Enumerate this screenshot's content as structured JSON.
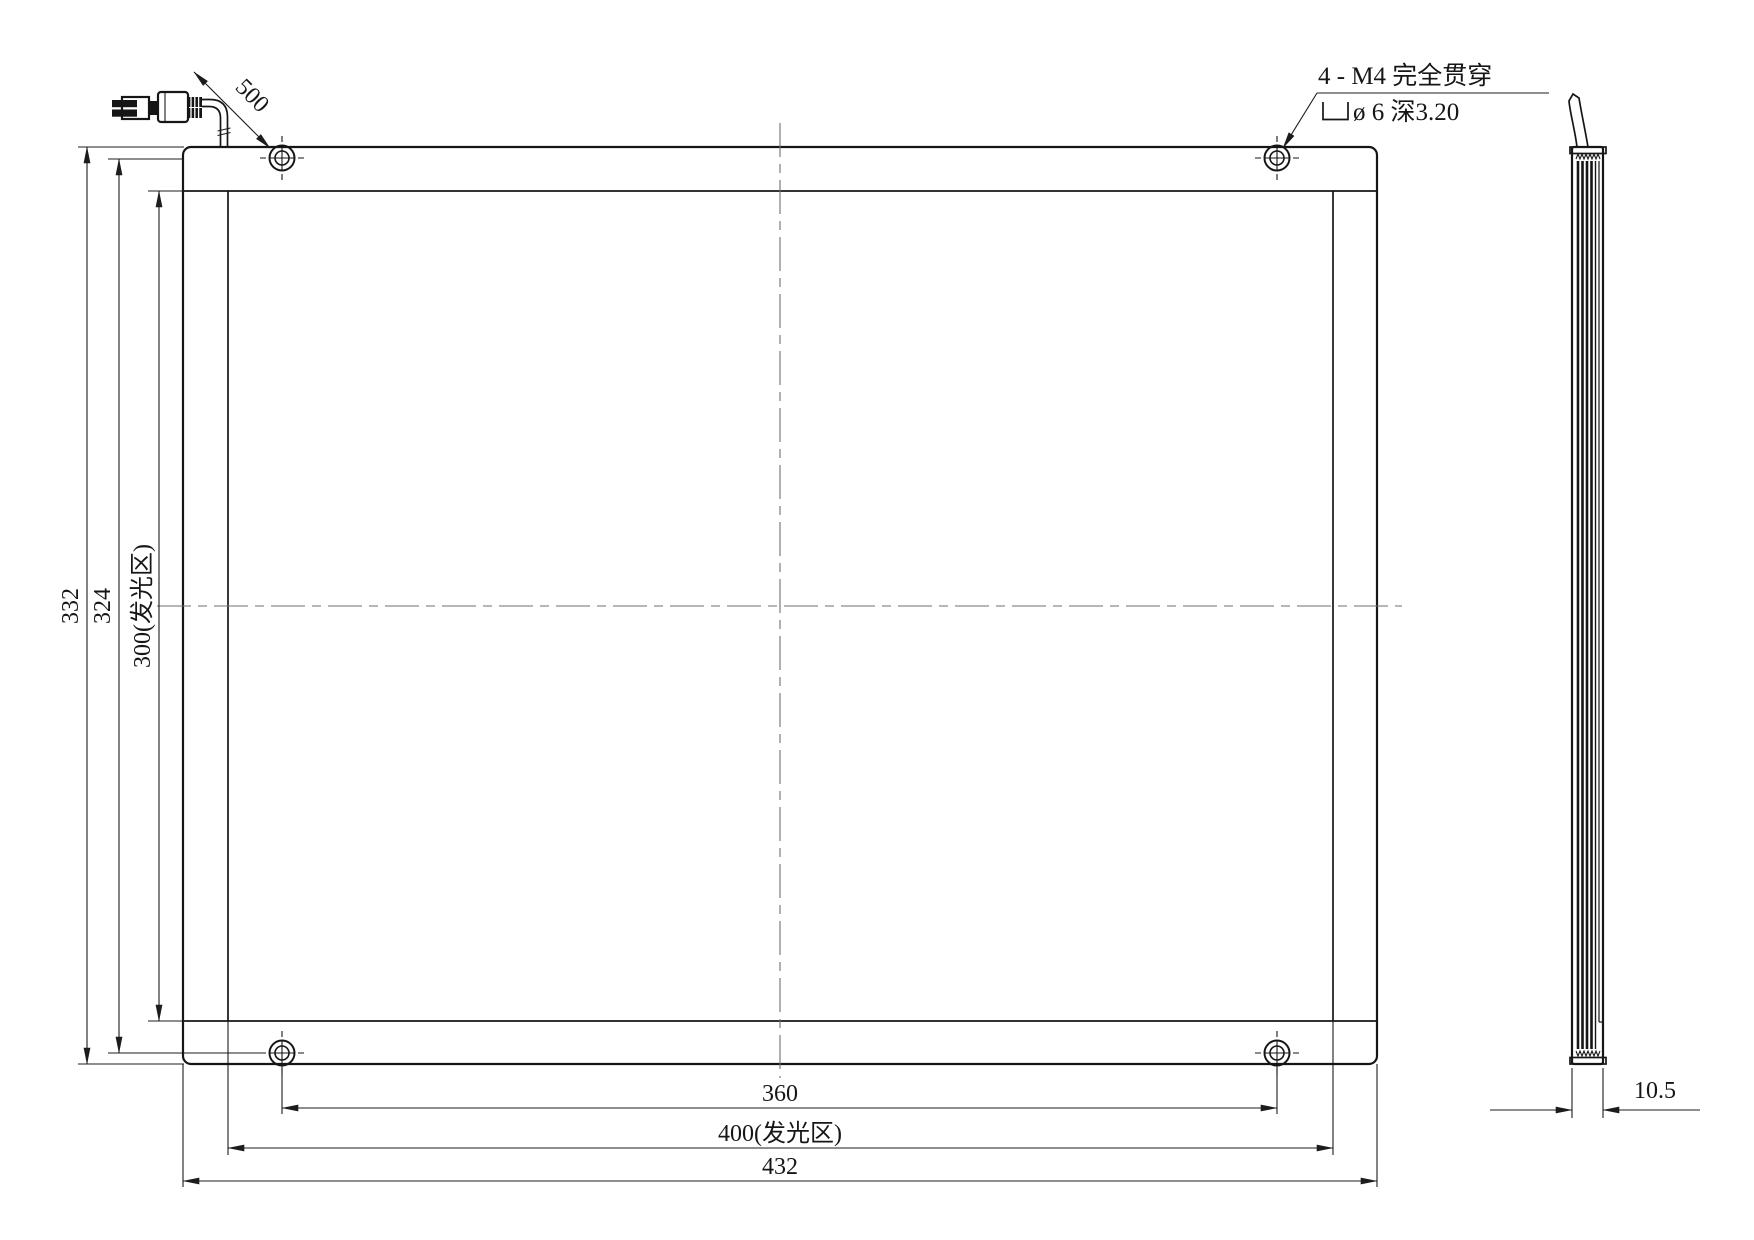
{
  "drawing": {
    "type": "mechanical-engineering-drawing",
    "views": {
      "front": {
        "dim_overall_width": "432",
        "dim_luminous_width": "400(发光区)",
        "dim_mount_hole_pitch_width": "360",
        "dim_overall_height": "332",
        "dim_mount_hole_pitch_height": "324",
        "dim_luminous_height": "300(发光区)",
        "dim_cable_length": "500"
      },
      "side": {
        "dim_thickness": "10.5"
      }
    },
    "callout": {
      "line1": "4 - M4 完全贯穿",
      "line2": "ø 6 深3.20",
      "symbol": "counterbore"
    },
    "colors": {
      "background": "#ffffff",
      "line": "#1c1c1c",
      "centerline": "#6f6f6f"
    }
  }
}
